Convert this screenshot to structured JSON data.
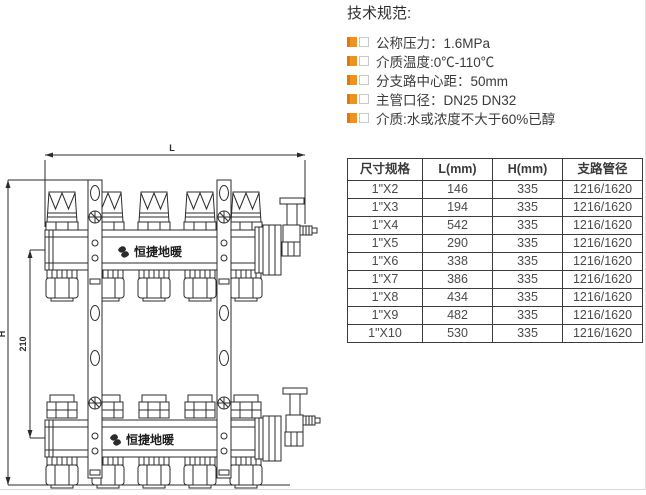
{
  "specs": {
    "title": "技术规范:",
    "items": [
      "公称压力：1.6MPa",
      "介质温度:0℃-110℃",
      "分支路中心距：50mm",
      "主管口径：DN25  DN32",
      "介质:水或浓度不大于60%已醇"
    ],
    "bullet_color": "#F0921E"
  },
  "drawing": {
    "length_label": "L",
    "height_label": "H",
    "center_distance_label": "210",
    "brand": "恒捷地暖"
  },
  "table": {
    "headers": [
      "尺寸规格",
      "L(mm)",
      "H(mm)",
      "支路管径"
    ],
    "rows": [
      [
        "1\"X2",
        "146",
        "335",
        "1216/1620"
      ],
      [
        "1\"X3",
        "194",
        "335",
        "1216/1620"
      ],
      [
        "1\"X4",
        "542",
        "335",
        "1216/1620"
      ],
      [
        "1\"X5",
        "290",
        "335",
        "1216/1620"
      ],
      [
        "1\"X6",
        "338",
        "335",
        "1216/1620"
      ],
      [
        "1\"X7",
        "386",
        "335",
        "1216/1620"
      ],
      [
        "1\"X8",
        "434",
        "335",
        "1216/1620"
      ],
      [
        "1\"X9",
        "482",
        "335",
        "1216/1620"
      ],
      [
        "1\"X10",
        "530",
        "335",
        "1216/1620"
      ]
    ]
  }
}
